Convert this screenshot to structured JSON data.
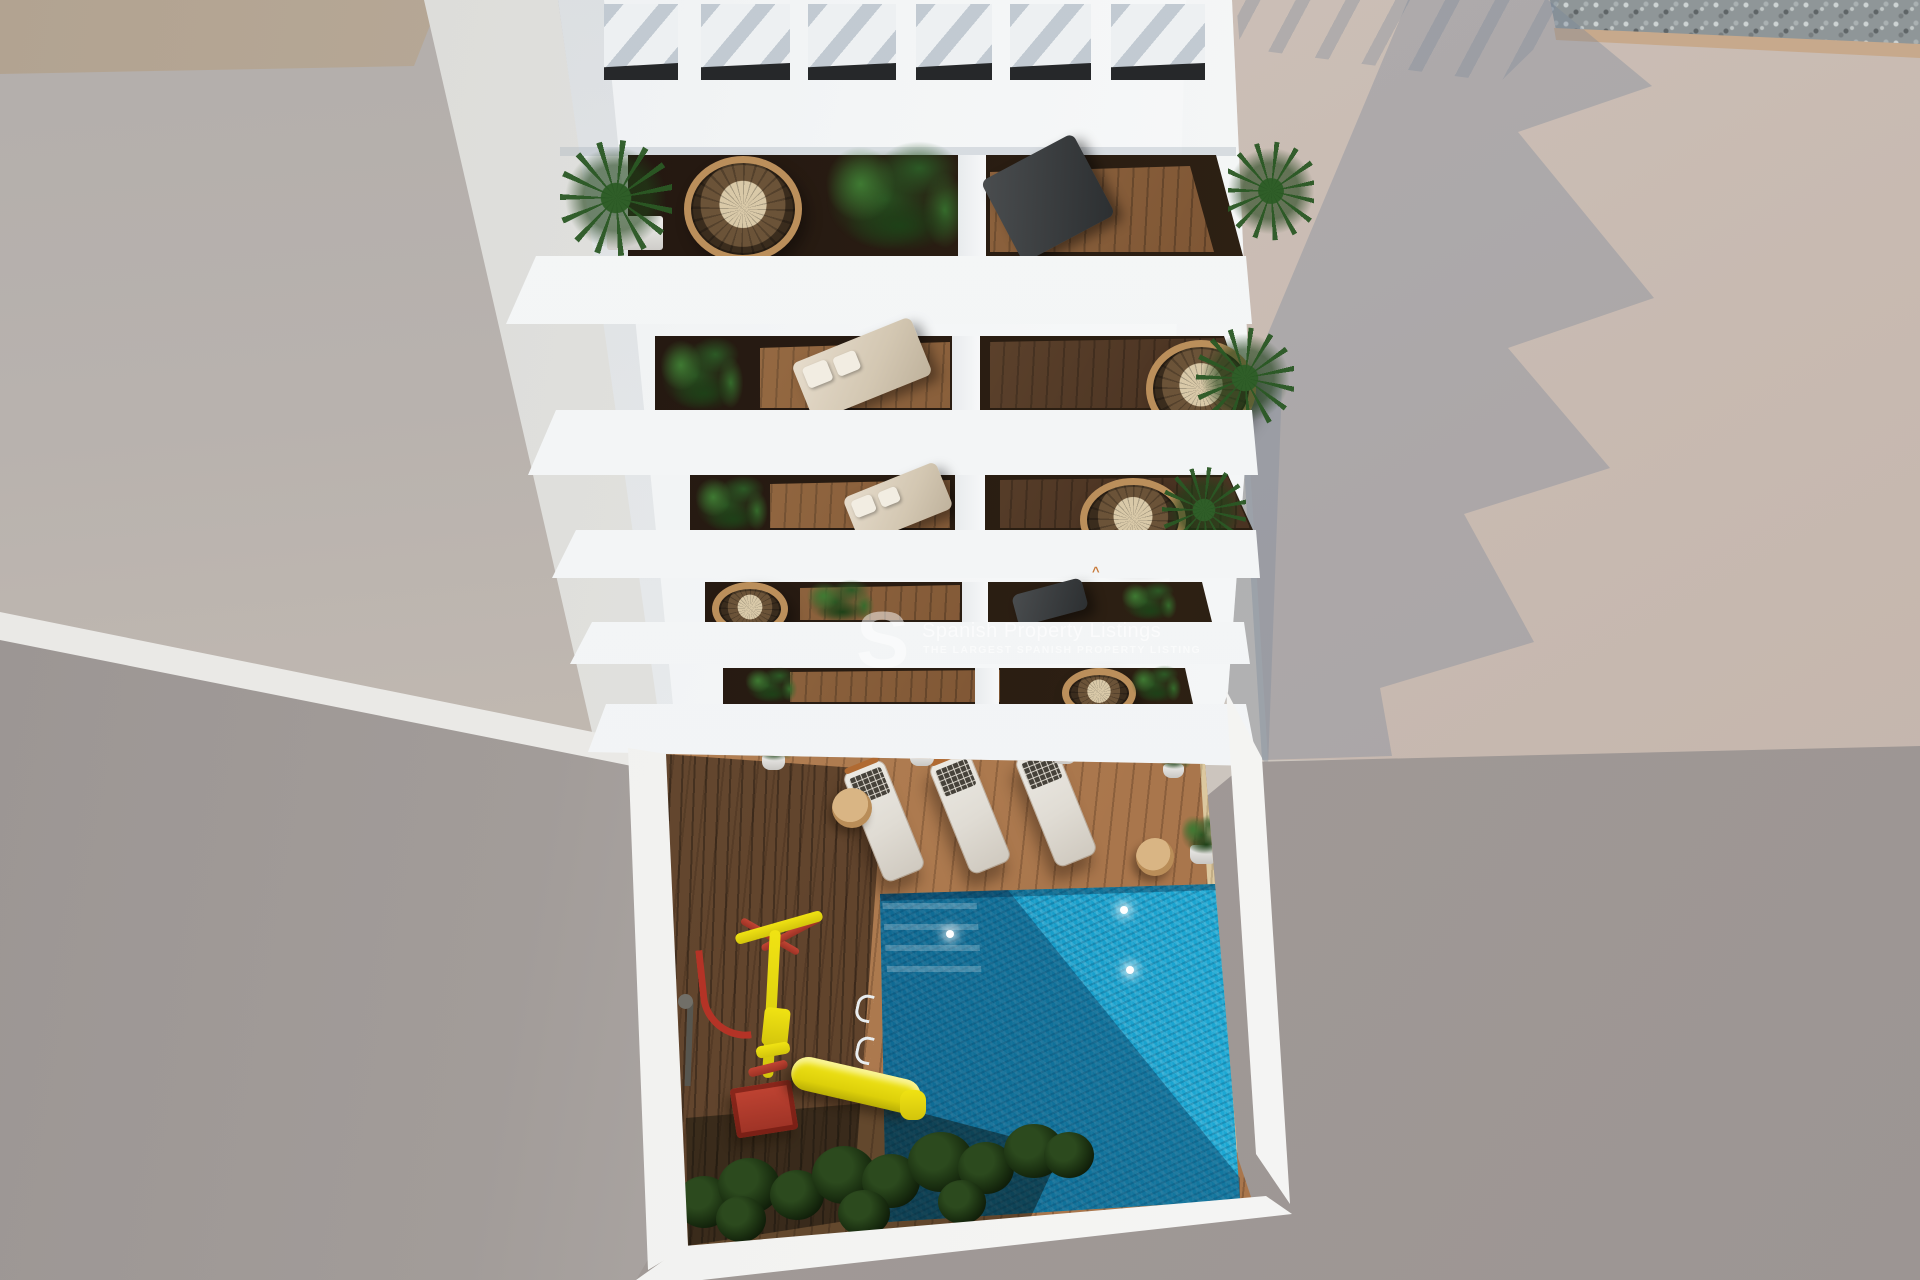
{
  "watermark": {
    "logo": "S",
    "title": "Spanish Property Listings",
    "subtitle": "THE LARGEST SPANISH PROPERTY LISTING"
  },
  "scene": {
    "description_labels": {
      "building": "white apartment building aerial view",
      "roof": "white pergola roof slats",
      "balcony_floors": "5",
      "pool": "blue swimming pool",
      "sun_loungers": "3",
      "playground": "red and yellow swing set with slide",
      "caret_mark": "^"
    },
    "palette": {
      "ground_light": "#cbc4bd",
      "ground_shadow": "#9c9593",
      "building_white": "#f3f5f6",
      "balcony_interior": "#241811",
      "deck_wood": "#a9764c",
      "deck_wood_dark": "#4a3322",
      "sand_strip": "#dcc89f",
      "pool_bright": "#20b2dd",
      "pool_dark": "#0e5f8c",
      "foliage_green": "#2c5a26",
      "rattan_tan": "#bb8f5b",
      "playground_red": "#b43326",
      "playground_yellow": "#e8d513",
      "gravel": "#8f9698"
    }
  }
}
